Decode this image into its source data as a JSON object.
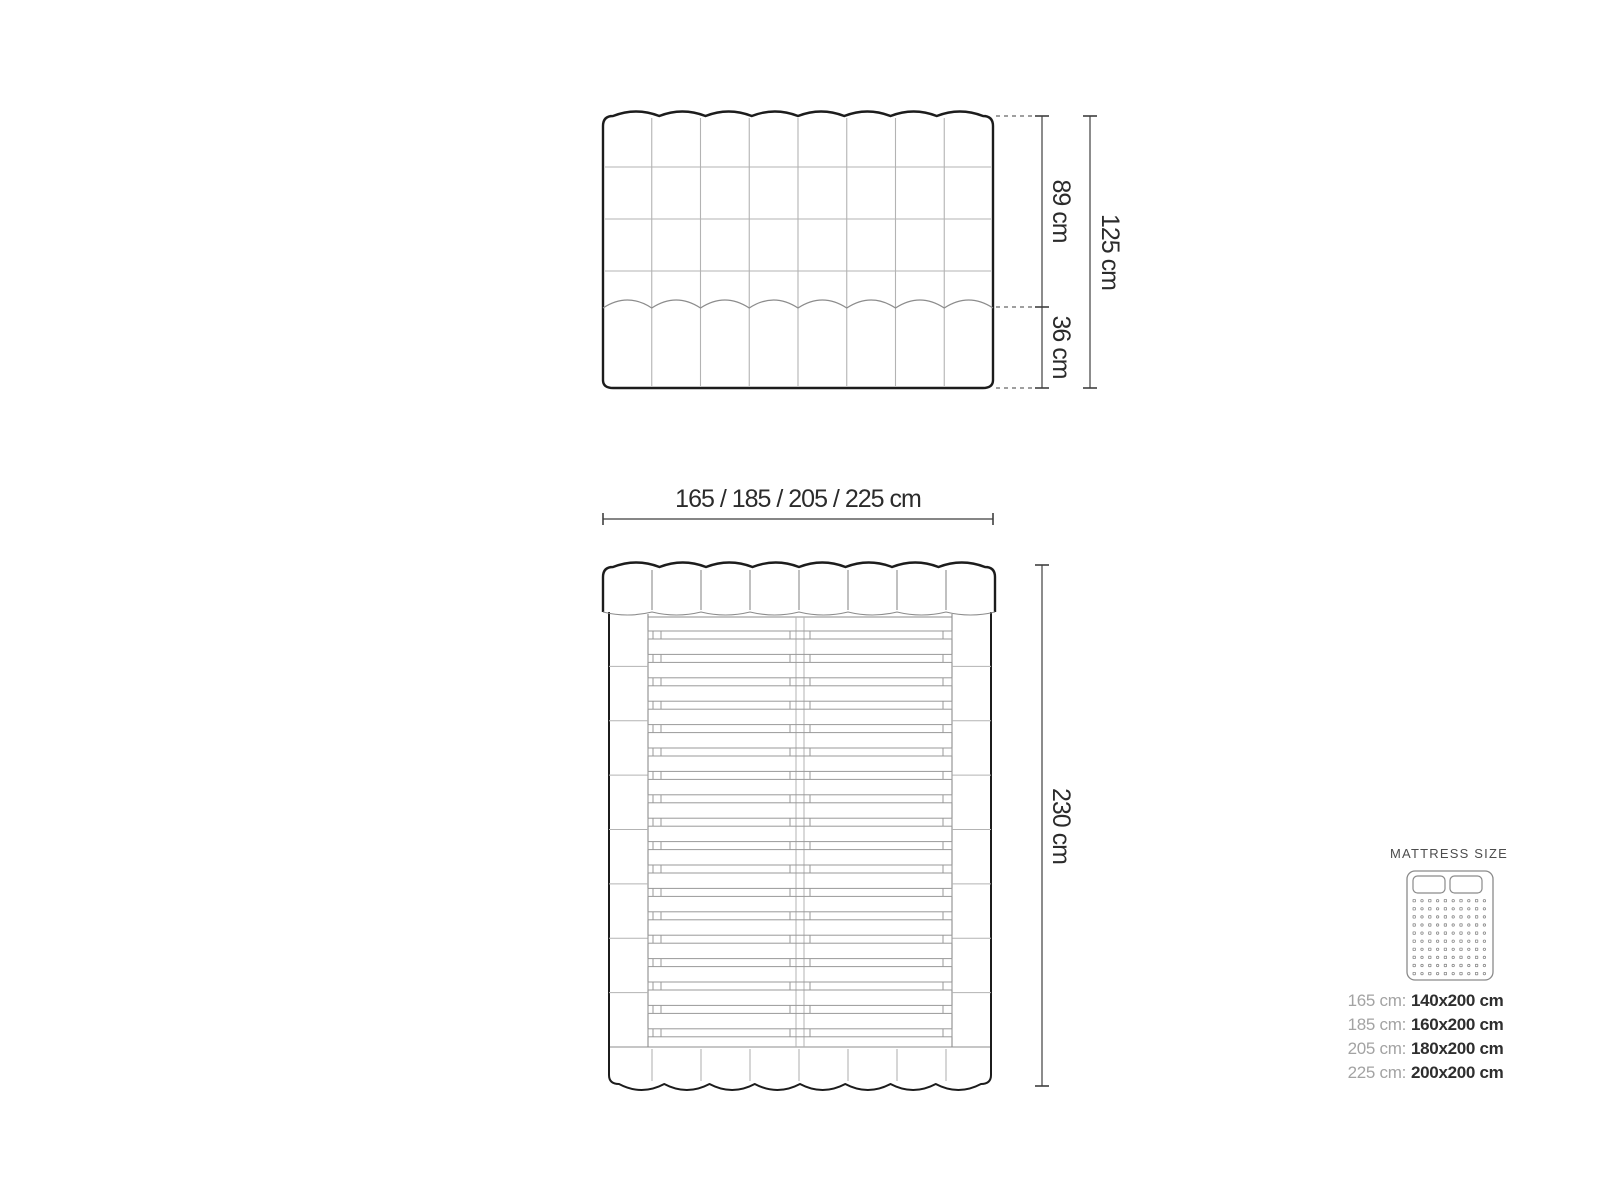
{
  "front_view": {
    "dim_upper": "89 cm",
    "dim_lower": "36 cm",
    "dim_total": "125 cm",
    "columns": 8,
    "upper_rows": 4,
    "lower_rows": 1
  },
  "width_dimension": {
    "label": "165 / 185 / 205 / 225 cm"
  },
  "top_view": {
    "dim_length": "230 cm",
    "columns": 8,
    "slat_count": 18,
    "side_sections_per_rail": 8
  },
  "mattress_panel": {
    "title": "MATTRESS SIZE",
    "icon": {
      "pillow_count": 2,
      "dot_rows": 10,
      "dot_cols": 10
    },
    "rows": [
      {
        "label": "165 cm:",
        "value": "140x200 cm"
      },
      {
        "label": "185 cm:",
        "value": "160x200 cm"
      },
      {
        "label": "205 cm:",
        "value": "180x200 cm"
      },
      {
        "label": "225 cm:",
        "value": "200x200 cm"
      }
    ]
  },
  "colors": {
    "background": "#ffffff",
    "outline": "#1c1c1c",
    "grid_light": "#b3b3b3",
    "grid_mid": "#8c8c8c",
    "slat": "#999999",
    "dimension": "#3f3f3f",
    "dim_text": "#2b2b2b",
    "panel_title": "#4d4d4d",
    "size_label": "#a3a3a3",
    "size_value": "#2e2e2e",
    "icon_stroke": "#8a8a8a"
  }
}
